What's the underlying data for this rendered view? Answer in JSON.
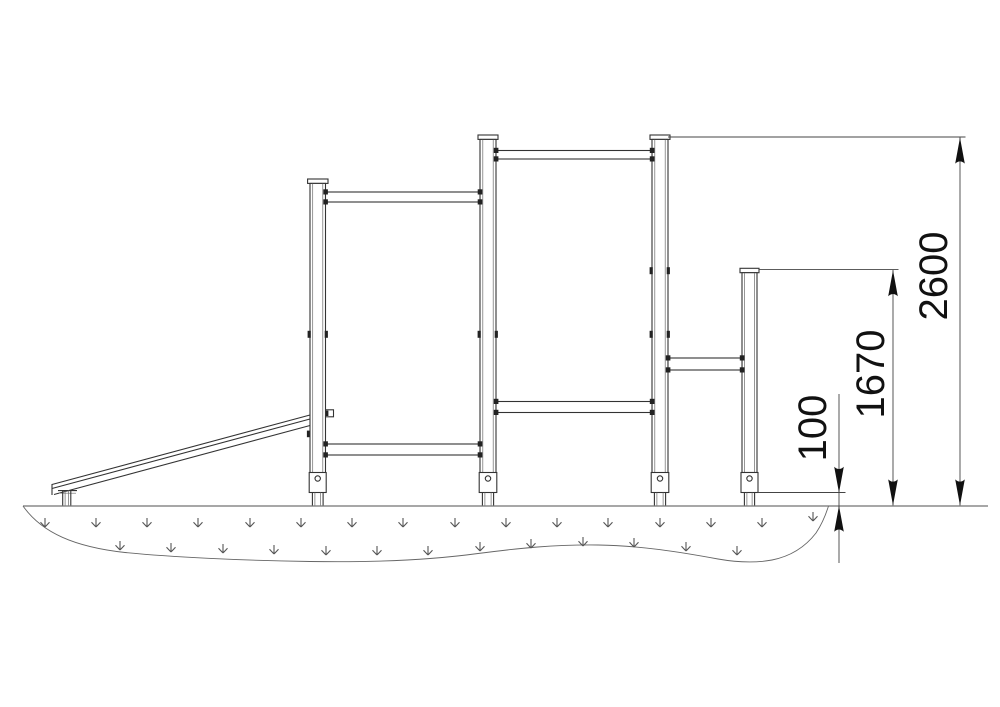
{
  "diagram": {
    "dimensions": [
      {
        "id": "overall-height",
        "label": "2600"
      },
      {
        "id": "low-post-height",
        "label": "1670"
      },
      {
        "id": "surfacing-thickness",
        "label": "100"
      }
    ],
    "colors": {
      "background": "#ffffff",
      "structure_line": "#333333",
      "ground_line": "#8a8a8a",
      "dimension_line": "#444444",
      "dimension_text": "#111111"
    },
    "icons": {
      "grass_tuft": "crow-foot-down",
      "dimension_arrow": "filled-triangle-arrowhead"
    }
  }
}
